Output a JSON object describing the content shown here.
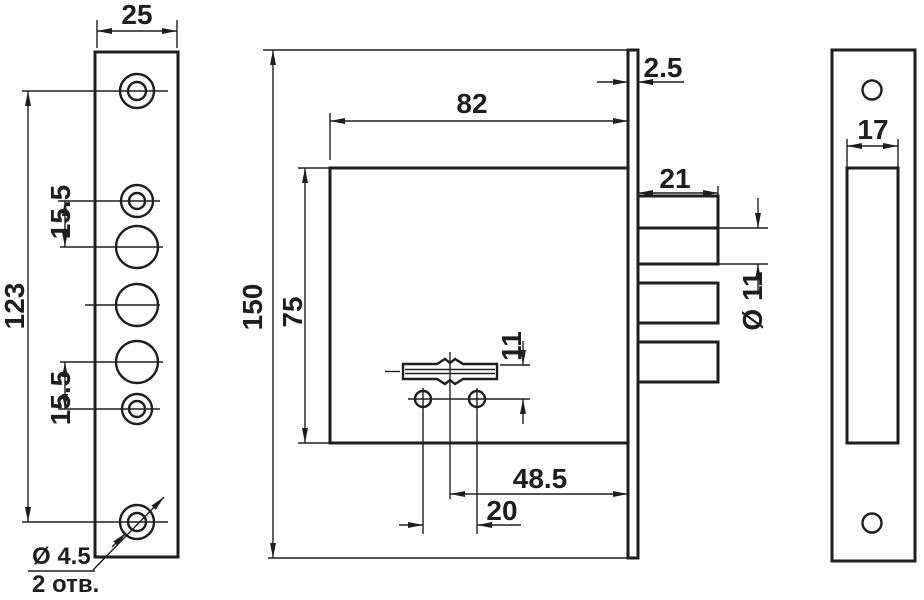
{
  "front_view": {
    "plate_width": "25",
    "screw_span": "123",
    "pitch_top": "15.5",
    "pitch_bottom": "15.5",
    "screw_note_diameter": "Ø 4.5",
    "screw_note_quantity": "2 отв."
  },
  "side_view": {
    "overall_height": "150",
    "case_height": "75",
    "case_depth": "82",
    "faceplate_thickness": "2.5",
    "bolt_throw": "21",
    "bolt_diameter": "Ø 11",
    "keyhole_to_screws": "11",
    "backset": "48.5",
    "screw_spacing": "20"
  },
  "strike_view": {
    "slot_width": "17"
  }
}
